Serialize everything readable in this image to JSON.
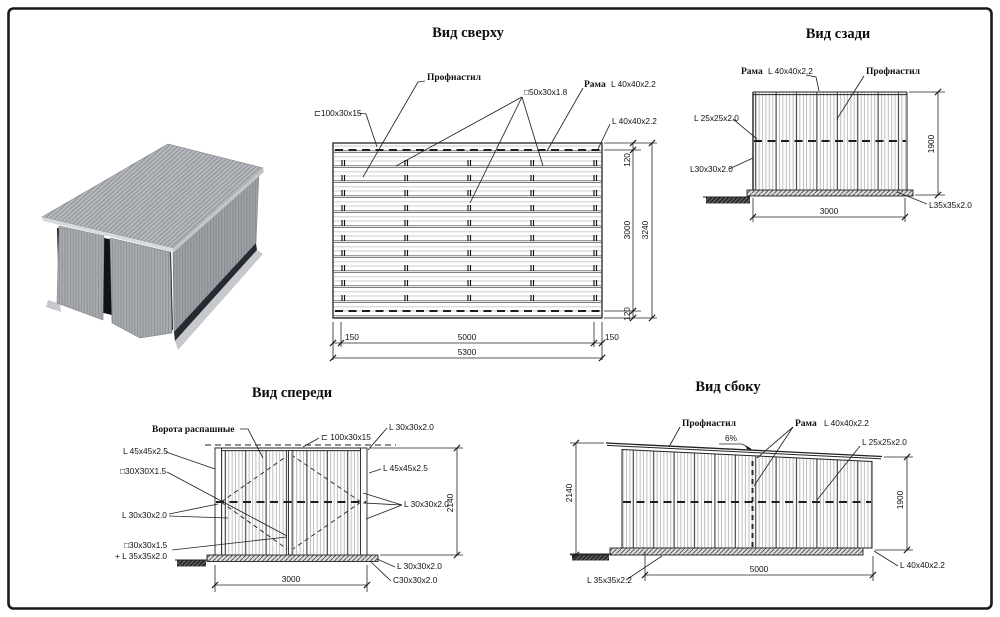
{
  "views": {
    "top": {
      "title": "Вид сверху",
      "labels": {
        "channel": "⊏100x30x15",
        "profnastil": "Профнастил",
        "tube": "□50x30x1.8",
        "frame_word": "Рама",
        "frame_spec": "L 40x40x2.2",
        "angle": "L 40x40x2.2"
      },
      "dims": {
        "left_margin": "150",
        "span": "5000",
        "right_margin": "150",
        "total_width": "5300",
        "top_margin": "120",
        "depth": "3000",
        "bottom_margin": "120",
        "total_depth": "3240"
      }
    },
    "back": {
      "title": "Вид сзади",
      "labels": {
        "frame_word": "Рама",
        "frame_spec": "L 40x40x2.2",
        "profnastil": "Профнастил",
        "angle25": "L 25x25x2.0",
        "angle30": "L30x30x2.0",
        "angle35": "L35x35x2.0"
      },
      "dims": {
        "height": "1900",
        "width": "3000"
      }
    },
    "front": {
      "title": "Вид спереди",
      "labels": {
        "gates": "Ворота распашные",
        "channel": "⊏ 100x30x15",
        "angle30_top_right": "L 30x30x2.0",
        "angle45_left": "L 45x45x2.5",
        "tube30_left": "□30X30X1.5",
        "angle30_left": "L 30x30x2.0",
        "tube30_bottom": "□30x30x1.5",
        "angle35_bottom": "+ L 35x35x2.0",
        "angle45_right": "L 45x45x2.5",
        "angle30_right": "L 30x30x2.0",
        "angle30_bottom_right": "L 30x30x2.0",
        "c30_bottom_right": "C30x30x2.0"
      },
      "dims": {
        "height": "2140",
        "width": "3000"
      }
    },
    "side": {
      "title": "Вид сбоку",
      "labels": {
        "profnastil": "Профнастил",
        "frame_word": "Рама",
        "frame_spec": "L 40x40x2.2",
        "slope": "6%",
        "angle25": "L 25x25x2.0",
        "angle35": "L 35x35x2.2",
        "angle40": "L 40x40x2.2"
      },
      "dims": {
        "height_left": "2140",
        "height_right": "1900",
        "width": "5000"
      }
    }
  }
}
